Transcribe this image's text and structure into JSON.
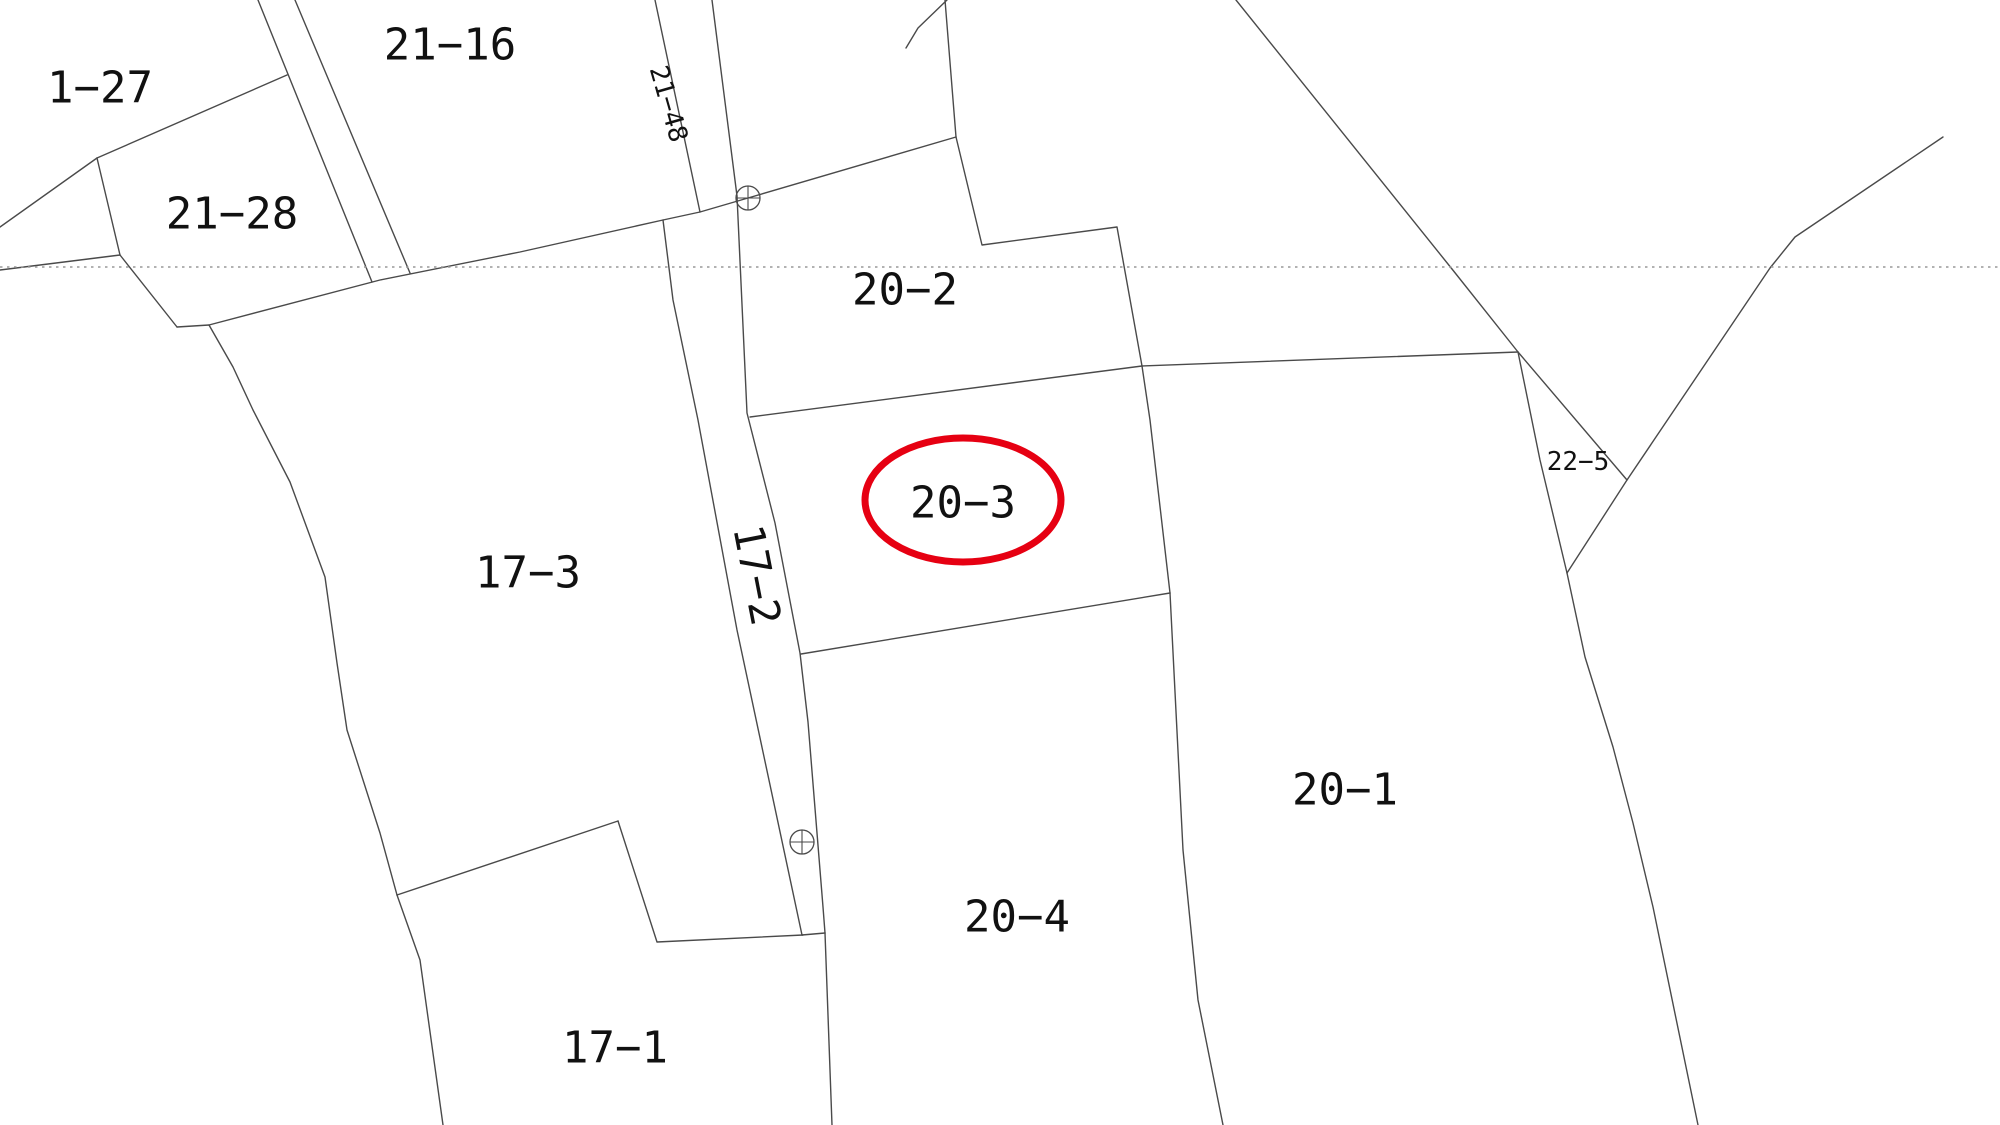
{
  "map": {
    "background_color": "#ffffff",
    "line_color": "#4a4a4a",
    "line_width": 1.4,
    "dotted_line_color": "#999999",
    "text_color": "#111111",
    "highlight_ellipse": {
      "parcel": "20-3",
      "color": "#e60012",
      "cx": 963,
      "cy": 500,
      "rx": 98,
      "ry": 62,
      "stroke_width": 7
    },
    "dotted_line": {
      "y": 267,
      "x1": 0,
      "x2": 2000
    },
    "survey_markers": [
      {
        "name": "survey-marker-upper",
        "x": 748,
        "y": 198,
        "r": 12
      },
      {
        "name": "survey-marker-lower",
        "x": 802,
        "y": 842,
        "r": 12
      }
    ],
    "labels": [
      {
        "id": "p21-27",
        "text": "1-27",
        "x": 100,
        "y": 88,
        "size": 44,
        "rot": 0
      },
      {
        "id": "p21-16",
        "text": "21-16",
        "x": 450,
        "y": 45,
        "size": 44,
        "rot": 0
      },
      {
        "id": "p21-28",
        "text": "21-28",
        "x": 232,
        "y": 214,
        "size": 44,
        "rot": 0
      },
      {
        "id": "p21-48",
        "text": "21-48",
        "x": 668,
        "y": 104,
        "size": 26,
        "rot": 74
      },
      {
        "id": "p20-2",
        "text": "20-2",
        "x": 905,
        "y": 290,
        "size": 44,
        "rot": 0
      },
      {
        "id": "p20-3",
        "text": "20-3",
        "x": 963,
        "y": 503,
        "size": 44,
        "rot": 0
      },
      {
        "id": "p17-3",
        "text": "17-3",
        "x": 528,
        "y": 573,
        "size": 44,
        "rot": 0
      },
      {
        "id": "p17-2",
        "text": "17-2",
        "x": 757,
        "y": 575,
        "size": 42,
        "rot": 79
      },
      {
        "id": "p22-5",
        "text": "22-5",
        "x": 1578,
        "y": 462,
        "size": 26,
        "rot": 0
      },
      {
        "id": "p20-1",
        "text": "20-1",
        "x": 1345,
        "y": 790,
        "size": 44,
        "rot": 0
      },
      {
        "id": "p20-4",
        "text": "20-4",
        "x": 1017,
        "y": 917,
        "size": 44,
        "rot": 0
      },
      {
        "id": "p17-1",
        "text": "17-1",
        "x": 615,
        "y": 1048,
        "size": 44,
        "rot": 0
      }
    ],
    "boundaries": [
      {
        "name": "strip-a-left",
        "points": [
          [
            258,
            0
          ],
          [
            372,
            282
          ]
        ]
      },
      {
        "name": "strip-a-right",
        "points": [
          [
            295,
            0
          ],
          [
            410,
            273
          ]
        ]
      },
      {
        "name": "b21-28-top",
        "points": [
          [
            97,
            158
          ],
          [
            287,
            75
          ]
        ]
      },
      {
        "name": "b21-27-21-28",
        "points": [
          [
            97,
            158
          ],
          [
            0,
            227
          ]
        ]
      },
      {
        "name": "b21-28-left",
        "points": [
          [
            97,
            158
          ],
          [
            120,
            255
          ]
        ]
      },
      {
        "name": "left-edge-line",
        "points": [
          [
            0,
            270
          ],
          [
            120,
            255
          ]
        ]
      },
      {
        "name": "b21-28-wedge",
        "points": [
          [
            120,
            255
          ],
          [
            177,
            327
          ]
        ]
      },
      {
        "name": "long-boundary-b1",
        "points": [
          [
            177,
            327
          ],
          [
            209,
            325
          ],
          [
            380,
            280
          ],
          [
            520,
            252
          ],
          [
            663,
            220
          ],
          [
            700,
            212
          ],
          [
            748,
            198
          ],
          [
            956,
            137
          ]
        ]
      },
      {
        "name": "strip-21-48-left",
        "points": [
          [
            655,
            0
          ],
          [
            700,
            212
          ]
        ]
      },
      {
        "name": "strip-21-48-right",
        "points": [
          [
            712,
            0
          ],
          [
            737,
            196
          ]
        ]
      },
      {
        "name": "top-sliver",
        "points": [
          [
            947,
            0
          ],
          [
            918,
            28
          ],
          [
            906,
            48
          ]
        ]
      },
      {
        "name": "b21-16-right",
        "points": [
          [
            945,
            0
          ],
          [
            956,
            137
          ]
        ]
      },
      {
        "name": "b20-2-notch",
        "points": [
          [
            956,
            137
          ],
          [
            982,
            245
          ],
          [
            1117,
            227
          ],
          [
            1142,
            366
          ]
        ]
      },
      {
        "name": "b20-2-bottom",
        "points": [
          [
            750,
            417
          ],
          [
            1142,
            366
          ]
        ]
      },
      {
        "name": "b20-1-top",
        "points": [
          [
            1142,
            366
          ],
          [
            1518,
            352
          ]
        ]
      },
      {
        "name": "b20-3-right",
        "points": [
          [
            1142,
            366
          ],
          [
            1150,
            420
          ],
          [
            1170,
            593
          ]
        ]
      },
      {
        "name": "b20-4-right",
        "points": [
          [
            1170,
            593
          ],
          [
            1183,
            850
          ],
          [
            1198,
            1000
          ],
          [
            1223,
            1125
          ]
        ]
      },
      {
        "name": "b20-3-bottom",
        "points": [
          [
            801,
            654
          ],
          [
            1170,
            593
          ]
        ]
      },
      {
        "name": "strip-17-2-left",
        "points": [
          [
            663,
            220
          ],
          [
            673,
            300
          ],
          [
            698,
            420
          ],
          [
            737,
            630
          ],
          [
            802,
            935
          ]
        ]
      },
      {
        "name": "strip-17-2-right",
        "points": [
          [
            737,
            196
          ],
          [
            747,
            413
          ],
          [
            775,
            523
          ],
          [
            800,
            653
          ],
          [
            808,
            722
          ],
          [
            823,
            907
          ],
          [
            825,
            933
          ]
        ]
      },
      {
        "name": "strip-17-2-jog",
        "points": [
          [
            802,
            935
          ],
          [
            825,
            933
          ]
        ]
      },
      {
        "name": "below-strip",
        "points": [
          [
            825,
            933
          ],
          [
            832,
            1125
          ]
        ]
      },
      {
        "name": "b17-3-left",
        "points": [
          [
            209,
            325
          ],
          [
            233,
            367
          ],
          [
            253,
            410
          ],
          [
            290,
            482
          ],
          [
            325,
            577
          ],
          [
            337,
            663
          ],
          [
            347,
            730
          ],
          [
            380,
            833
          ],
          [
            397,
            895
          ]
        ]
      },
      {
        "name": "b17-1-left",
        "points": [
          [
            397,
            895
          ],
          [
            420,
            960
          ],
          [
            443,
            1125
          ]
        ]
      },
      {
        "name": "b17-1-top",
        "points": [
          [
            397,
            895
          ],
          [
            618,
            821
          ]
        ]
      },
      {
        "name": "b17-1-right",
        "points": [
          [
            618,
            821
          ],
          [
            657,
            942
          ],
          [
            803,
            935
          ]
        ]
      },
      {
        "name": "long-diagonal-ne",
        "points": [
          [
            1236,
            0
          ],
          [
            1452,
            269
          ],
          [
            1518,
            352
          ],
          [
            1627,
            480
          ]
        ]
      },
      {
        "name": "tri-22-5-left",
        "points": [
          [
            1518,
            352
          ],
          [
            1540,
            460
          ],
          [
            1567,
            573
          ]
        ]
      },
      {
        "name": "long-diagonal-sw-ne",
        "points": [
          [
            1567,
            573
          ],
          [
            1627,
            480
          ],
          [
            1770,
            268
          ],
          [
            1795,
            237
          ],
          [
            1943,
            137
          ]
        ]
      },
      {
        "name": "b20-1-right",
        "points": [
          [
            1567,
            573
          ],
          [
            1585,
            657
          ],
          [
            1613,
            747
          ],
          [
            1633,
            823
          ],
          [
            1653,
            907
          ],
          [
            1698,
            1125
          ]
        ]
      }
    ]
  }
}
